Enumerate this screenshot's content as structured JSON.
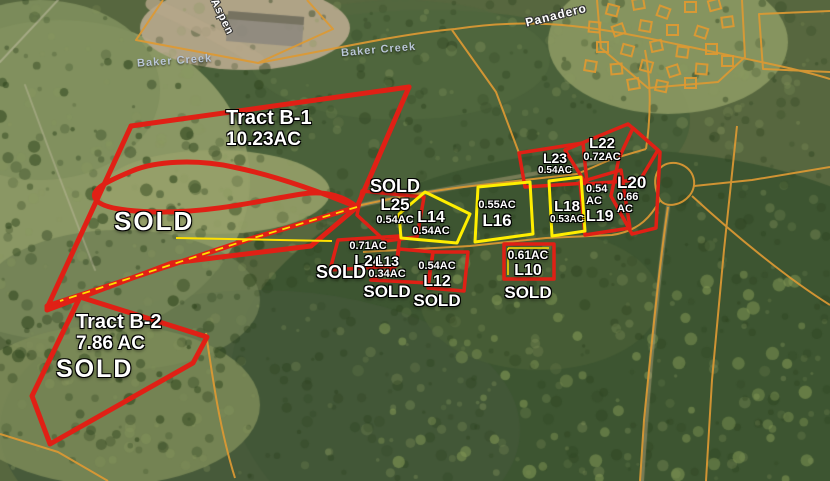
{
  "tracts": [
    {
      "name": "Tract B-1",
      "acreage": "10.23AC",
      "status": "SOLD"
    },
    {
      "name": "Tract B-2",
      "acreage": "7.86 AC",
      "status": "SOLD"
    }
  ],
  "lots": [
    {
      "id": "L25",
      "acreage": "0.54AC",
      "status": "SOLD"
    },
    {
      "id": "L24",
      "acreage": "0.71AC",
      "status": "SOLD"
    },
    {
      "id": "L13",
      "acreage": "0.34AC",
      "status": "SOLD"
    },
    {
      "id": "L12",
      "acreage": "0.54AC",
      "status": "SOLD"
    },
    {
      "id": "L10",
      "acreage": "0.61AC",
      "status": "SOLD"
    },
    {
      "id": "L14",
      "acreage": "0.54AC"
    },
    {
      "id": "L16",
      "acreage": "0.55AC"
    },
    {
      "id": "L18",
      "acreage": "0.53AC"
    },
    {
      "id": "L23",
      "acreage": "0.54AC"
    },
    {
      "id": "L22",
      "acreage": "0.72AC"
    },
    {
      "id": "L19",
      "acreage_line1": "0.54",
      "acreage_line2": "AC"
    },
    {
      "id": "L20",
      "acreage_line1": "0.66",
      "acreage_line2": "AC"
    }
  ],
  "road_labels": [
    {
      "name": "Aspen"
    },
    {
      "name": "Panadero"
    },
    {
      "name": "Baker Creek"
    },
    {
      "name": "Baker Creek"
    }
  ],
  "colors": {
    "sold_outline": "#e02015",
    "available_outline": "#ffee00",
    "parcel_lines": "#dd9933",
    "label_text": "#ffffff",
    "road_label_text": "#b9c6d6"
  }
}
